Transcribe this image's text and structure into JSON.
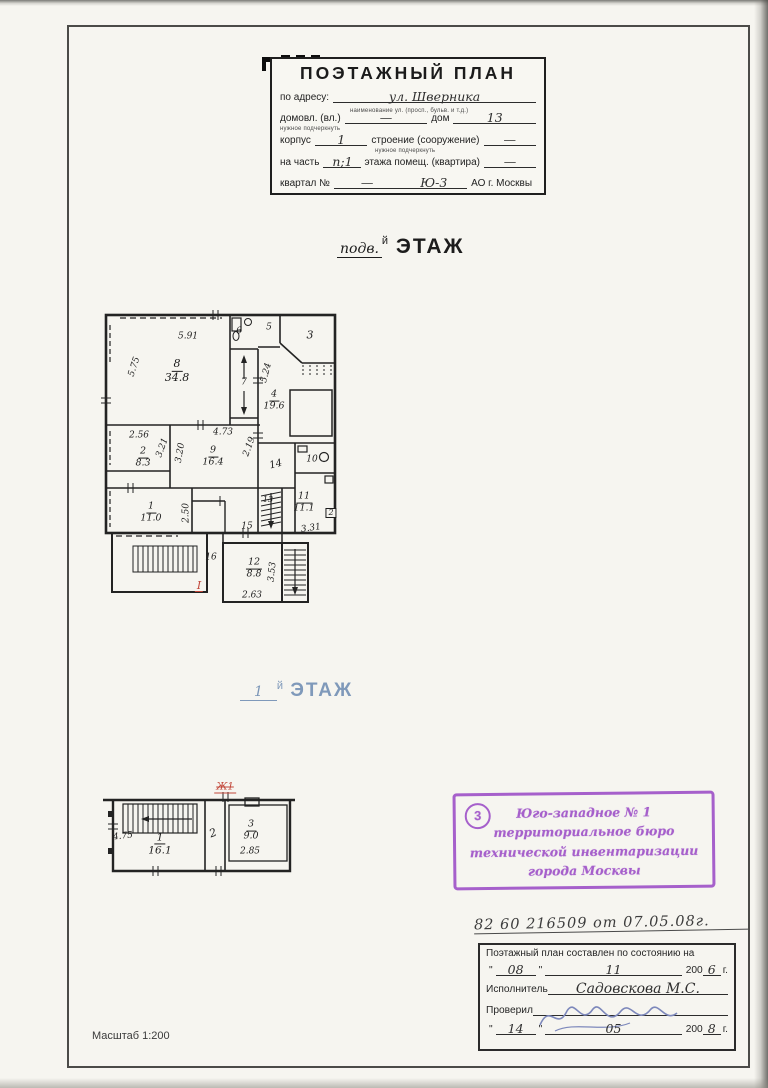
{
  "header": {
    "title": "ПОЭТАЖНЫЙ ПЛАН",
    "address_label": "по адресу:",
    "address_value": "ул. Шверника",
    "address_hint": "наименование ул. (просп., бульв. и т.д.)",
    "domovl_label": "домовл. (вл.)",
    "domovl_value": "—",
    "dom_label": "дом",
    "dom_value": "13",
    "underline_hint": "нужное подчеркнуть",
    "korpus_label": "корпус",
    "korpus_value": "1",
    "stroenie_label": "строение (сооружение)",
    "stroenie_value": "—",
    "chast_label": "на часть",
    "chast_value": "п;1",
    "pomesh_label": "этажа помещ. (квартира)",
    "pomesh_value": "—",
    "kvartal_label": "квартал №",
    "kvartal_value": "—",
    "okrug_value": "Ю-3",
    "city_label": "АО г. Москвы"
  },
  "basement": {
    "title_hand": "подв.",
    "title_sup": "й",
    "title_word": "ЭТАЖ",
    "rooms": [
      {
        "num": "8",
        "area": "34.8"
      },
      {
        "num": "4",
        "area": "19.6"
      },
      {
        "num": "2",
        "area": "8.3"
      },
      {
        "num": "9",
        "area": "16.4"
      },
      {
        "num": "1",
        "area": "11.0"
      },
      {
        "num": "11",
        "area": "11.1"
      },
      {
        "num": "12",
        "area": "8.8"
      }
    ],
    "numbers": [
      "6",
      "5",
      "3",
      "7",
      "14",
      "10",
      "15",
      "13",
      "16"
    ],
    "marker_box": "2",
    "dims": [
      "5.91",
      "5.75",
      "5.24",
      "2.56",
      "3.21",
      "3.20",
      "4.73",
      "2.19",
      "2.50",
      "3.31",
      "3.53",
      "2.63"
    ],
    "red_mark": "I"
  },
  "first_floor": {
    "title_value": "1",
    "title_sup": "й",
    "title_word": "ЭТАЖ",
    "rooms": [
      {
        "num": "1",
        "area": "16.1"
      },
      {
        "num": "3",
        "area": "9.0"
      }
    ],
    "numbers": [
      "2"
    ],
    "dims": [
      "4.75",
      "2.85"
    ],
    "red_mark": "Ж1"
  },
  "stamp": {
    "number": "3",
    "lines": [
      "Юго-западное № 1",
      "территориальное бюро",
      "технической инвентаризации",
      "города Москвы"
    ]
  },
  "registry": {
    "ref_line": "82 60 216509 от 07.05.08г.",
    "box_title": "Поэтажный план составлен по состоянию на",
    "quote": "\"",
    "date1_day": "08",
    "date1_month": "11",
    "year_prefix": "200",
    "date1_year": "6",
    "year_suffix": "г.",
    "executor_label": "Исполнитель",
    "executor_value": "Садовскова М.С.",
    "checker_label": "Проверил",
    "date2_day": "14",
    "date2_month": "05",
    "date2_year": "8"
  },
  "footer": {
    "scale": "Масштаб 1:200"
  }
}
